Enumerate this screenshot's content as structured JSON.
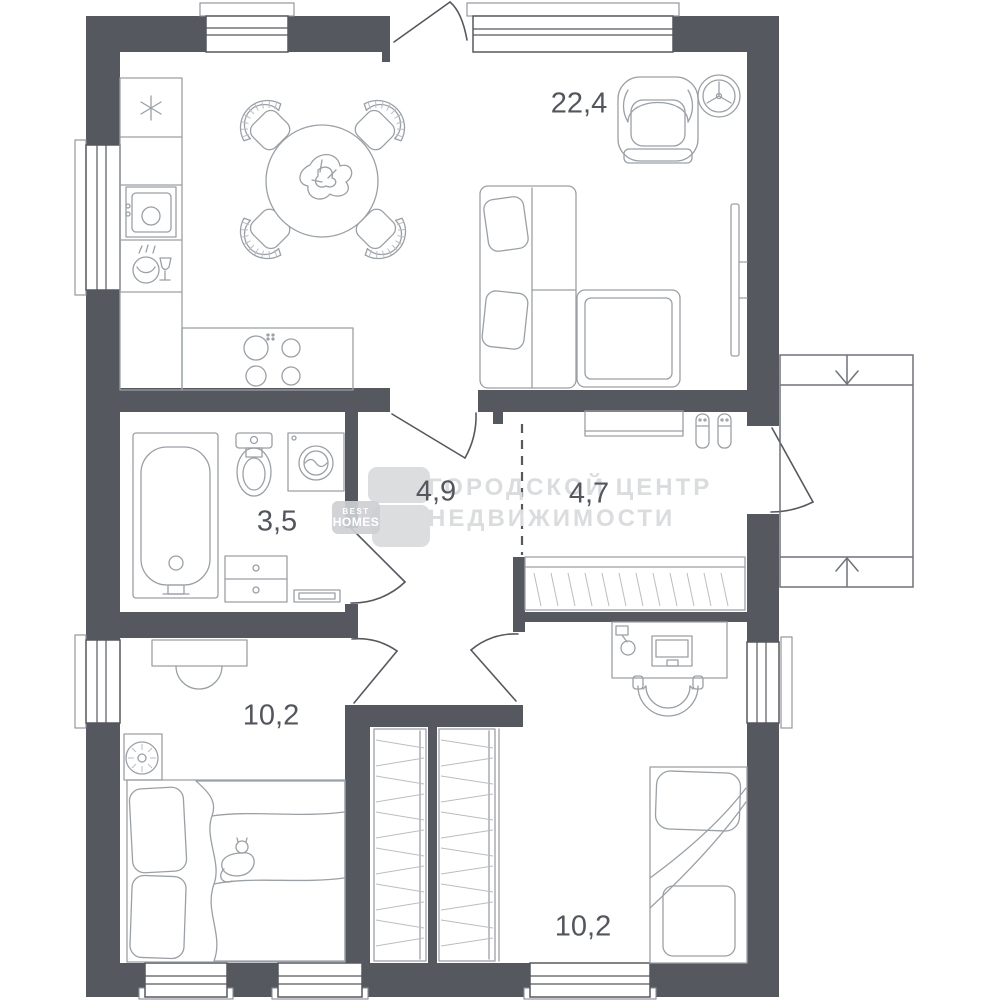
{
  "floorplan": {
    "title": "apartment floor plan",
    "rooms": [
      {
        "name": "living-kitchen",
        "area": "22,4"
      },
      {
        "name": "hallway-inner",
        "area": "4,9"
      },
      {
        "name": "entry-hall",
        "area": "4,7"
      },
      {
        "name": "bathroom",
        "area": "3,5"
      },
      {
        "name": "bedroom-left",
        "area": "10,2"
      },
      {
        "name": "bedroom-right",
        "area": "10,2"
      }
    ],
    "watermark": {
      "line1": "ГОРОДСКОЙ ЦЕНТР",
      "line2": "НЕДВИЖИМОСТИ"
    },
    "logo": {
      "top": "BEST",
      "bottom": "HOMES"
    },
    "colors": {
      "wall": "#55585F",
      "furniture_line": "#9AA0A7",
      "hatch_line": "#B9BEC4",
      "porch_line": "#6E727A",
      "label": "#53565E",
      "watermark": "#DBDCDE",
      "logo_box": "#D6D8DB"
    }
  }
}
